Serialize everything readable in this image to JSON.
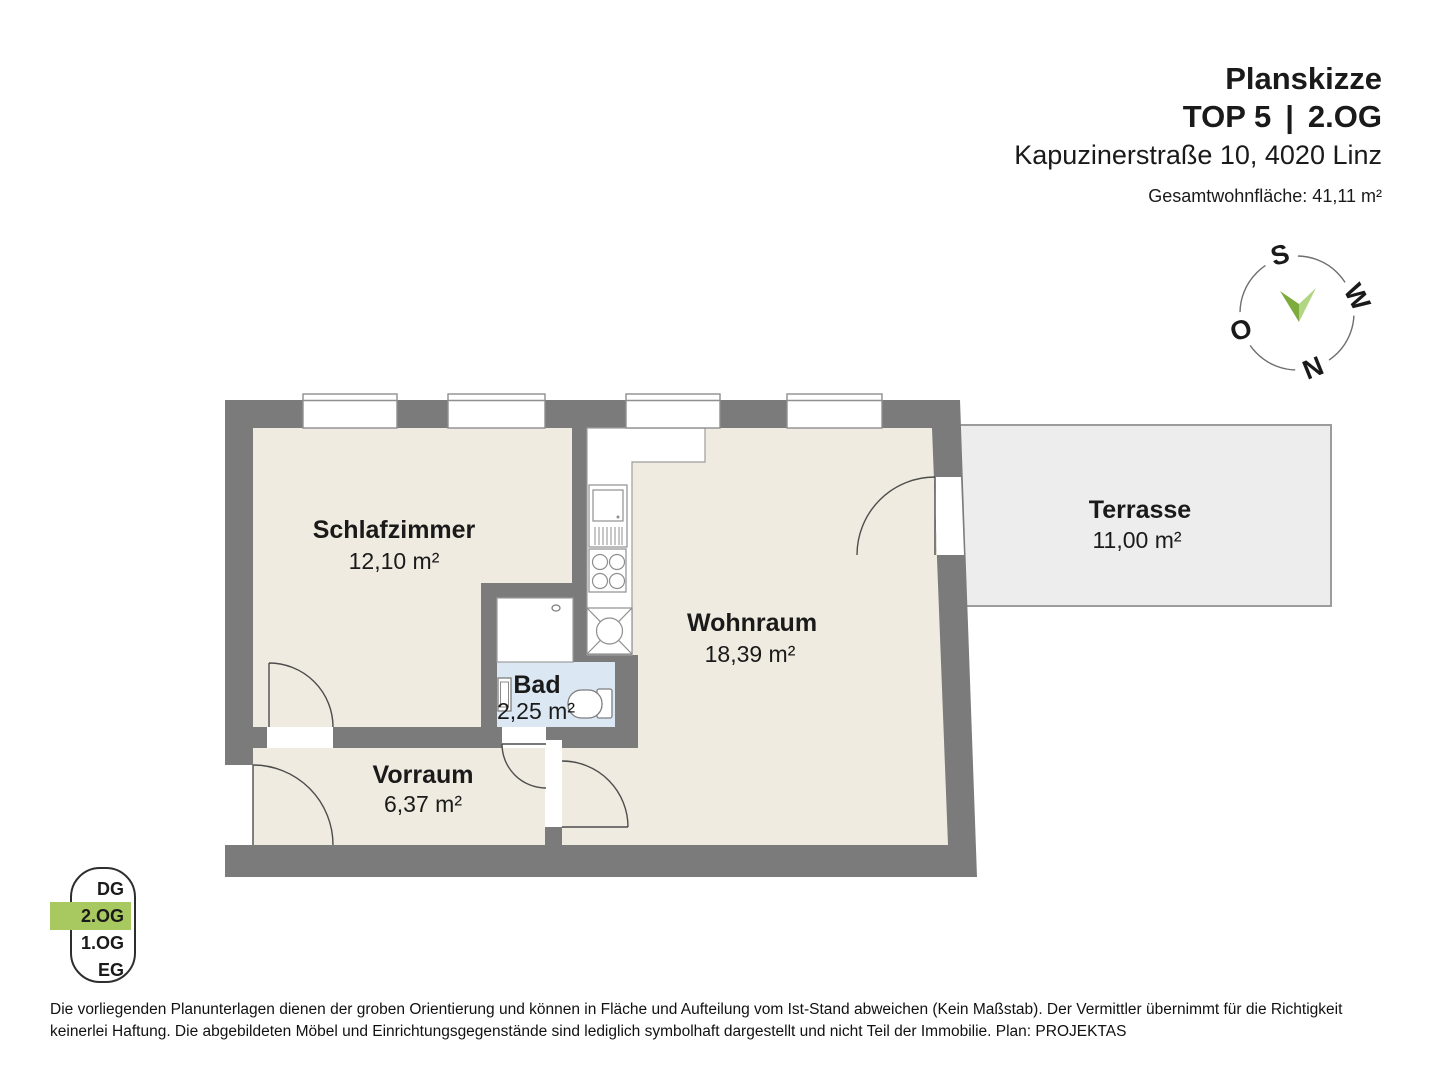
{
  "header": {
    "title": "Planskizze",
    "unit": "TOP 5",
    "pipe": "|",
    "floor": "2.OG",
    "address": "Kapuzinerstraße 10, 4020 Linz",
    "total_area": "Gesamtwohnfläche: 41,11 m²"
  },
  "compass": {
    "south": "S",
    "west": "W",
    "east": "O",
    "north": "N"
  },
  "rooms": {
    "schlafzimmer": {
      "name": "Schlafzimmer",
      "area": "12,10 m²"
    },
    "wohnraum": {
      "name": "Wohnraum",
      "area": "18,39 m²"
    },
    "bad": {
      "name": "Bad",
      "area": "2,25 m²"
    },
    "vorraum": {
      "name": "Vorraum",
      "area": "6,37 m²"
    },
    "terrasse": {
      "name": "Terrasse",
      "area": "11,00 m²"
    }
  },
  "floor_selector": {
    "floors": [
      "DG",
      "2.OG",
      "1.OG",
      "EG"
    ],
    "active": "2.OG"
  },
  "colors": {
    "wall": "#7b7b7b",
    "floor": "#f0ebe0",
    "bath_floor": "#dbe8f4",
    "terrace_fill": "#ededed",
    "terrace_border": "#9c9c9c",
    "highlight_green": "#a7c960",
    "needle_dark": "#7dab3c",
    "needle_light": "#b2d584"
  },
  "disclaimer": "Die vorliegenden Planunterlagen dienen der groben Orientierung und können in Fläche und Aufteilung vom Ist-Stand abweichen (Kein Maßstab). Der Vermittler übernimmt für die Richtigkeit keinerlei Haftung. Die abgebildeten Möbel und Einrichtungsgegenstände sind lediglich symbolhaft dargestellt und nicht Teil der Immobilie. Plan: PROJEKTAS"
}
